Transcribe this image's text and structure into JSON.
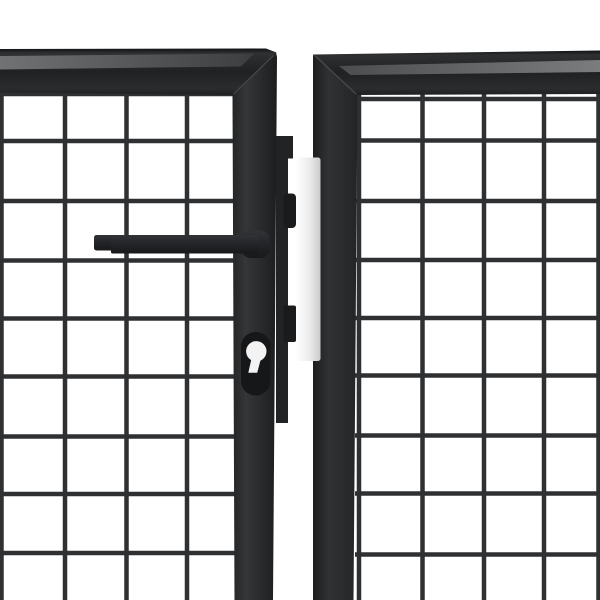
{
  "meta": {
    "title": "Product photo close-up: anthracite grey steel mesh double garden gate with lever handle and euro-cylinder lock",
    "image_type": "product-photo",
    "subject": "double garden gate, wire mesh infill, anthracite powder-coated steel",
    "background": "#ffffff"
  },
  "colors": {
    "background": "#ffffff",
    "frame_anthracite": "#2a2c2e",
    "frame_shadow": "#1d1f21",
    "frame_top_highlight": "#6e7072",
    "mesh_wire": "#2f3032",
    "lock_case_dark": "#212325",
    "bolt_dark": "#191b1d",
    "hardware_black": "#232528",
    "cover_plate_white": "#ffffff",
    "cover_plate_gray": "#c8cacb",
    "keyhole_white": "#f3f3f3",
    "escutcheon_black": "#151719",
    "miter_seam": "#47494b"
  },
  "scene": {
    "left_leaf": {
      "label": "left gate leaf (mesh panel with lock stile)",
      "mesh": {
        "wire_thickness": 4.5,
        "x_wires": [
          1.5,
          65,
          126.5,
          187
        ],
        "y_wires": [
          94,
          141,
          201,
          260.5,
          318.5,
          376.5,
          436.5,
          494,
          553
        ],
        "x_extent": [
          0,
          236
        ],
        "y_extent": [
          91,
          600
        ]
      }
    },
    "right_leaf": {
      "label": "right gate leaf (mesh panel)",
      "mesh": {
        "wire_thickness": 4.5,
        "x_wires": [
          359,
          422.5,
          484,
          544,
          598.5
        ],
        "y_wires": [
          99,
          140.5,
          201,
          260,
          318,
          375.5,
          435.5,
          493.5,
          554.5
        ],
        "x_extent": [
          355,
          600
        ],
        "y_extent": [
          94,
          600
        ]
      }
    },
    "hardware": {
      "handle": "black lever door handle",
      "lock_case": "mortise lock case on lock stile",
      "latch": "latch bolt",
      "deadbolt": "dead bolt",
      "cover_plate": "white strike cover plate between leaves",
      "cylinder": "euro profile cylinder keyhole"
    }
  }
}
